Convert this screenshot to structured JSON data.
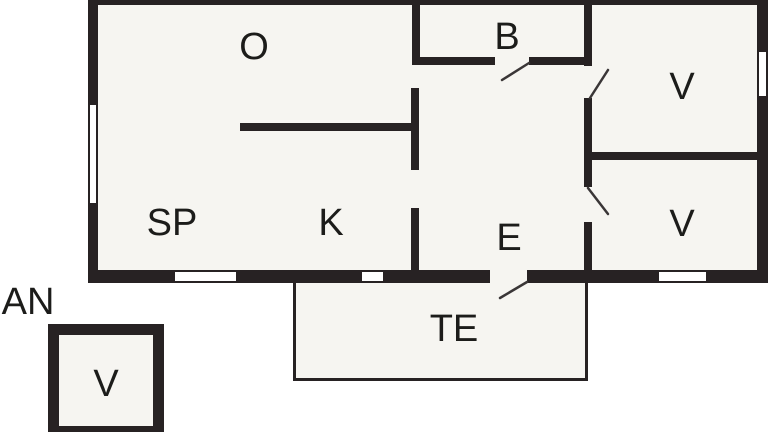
{
  "floorplan": {
    "rooms": {
      "o": {
        "label": "O"
      },
      "b": {
        "label": "B"
      },
      "v_top": {
        "label": "V"
      },
      "v_bottom": {
        "label": "V"
      },
      "sp": {
        "label": "SP"
      },
      "k": {
        "label": "K"
      },
      "e": {
        "label": "E"
      },
      "terrace": {
        "label": "TE"
      },
      "annex": {
        "label": "AN"
      },
      "annex_v": {
        "label": "V"
      }
    },
    "colors": {
      "wall": "#272223",
      "room_fill": "#f6f5f1",
      "line": "#3a3637",
      "text": "#1c1c1a"
    }
  }
}
